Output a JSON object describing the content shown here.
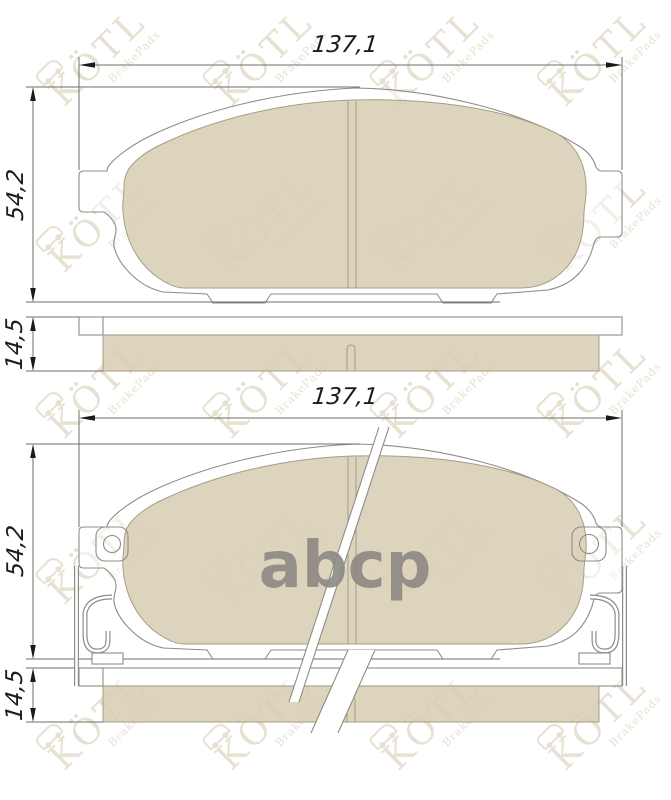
{
  "figures": {
    "top": {
      "width_label": "137,1",
      "height_label": "54,2",
      "thickness_label": "14,5"
    },
    "bottom": {
      "width_label": "137,1",
      "height_label": "54,2",
      "thickness_label": "14,5"
    }
  },
  "watermark": {
    "brand": "KÖTL",
    "subtitle": "BrakePads"
  },
  "center_logo": {
    "text": "abcp"
  },
  "colors": {
    "friction": "#ddd4bd",
    "outline": "#8d8c86",
    "dimension_text": "#1b1b1b",
    "watermark": "#e7e1d2",
    "center_logo": "#8e8b85"
  }
}
